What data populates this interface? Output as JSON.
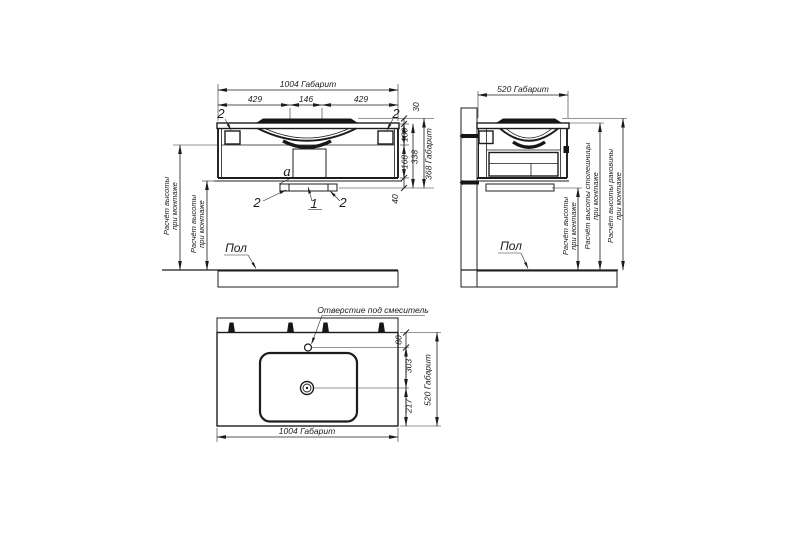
{
  "front_view": {
    "dim_width_total": "1004 Габарит",
    "dim_w_left": "429",
    "dim_w_center": "146",
    "dim_w_right": "429",
    "dim_h_rim": "30",
    "dim_h_basin": "130",
    "dim_h_body": "168",
    "dim_h_plinth": "40",
    "dim_h_under_top": "338",
    "dim_h_total": "368 Габарит",
    "callout_bracket": "2",
    "callout_center_bracket": "1",
    "callout_siphon": "a",
    "floor_label": "Пол",
    "mount_height_line1": "Расчёт высоты",
    "mount_height_line2": "при монтаже"
  },
  "side_view": {
    "dim_depth_total": "520 Габарит",
    "floor_label": "Пол",
    "mount_height_line1": "Расчёт высоты",
    "mount_height_line2": "при монтаже",
    "countertop_height_line1": "Расчёт высоты столешницы",
    "countertop_height_line2": "при монтаже",
    "sink_height_line1": "Расчёт высоты раковины",
    "sink_height_line2": "при монтаже"
  },
  "plan_view": {
    "mixer_callout": "Отверстие под смеситель",
    "dim_mixer_offset": "80",
    "dim_drain_offset": "303",
    "dim_drain_to_front": "217",
    "dim_depth_total": "520 Габарит",
    "dim_width_total": "1004 Габарит"
  }
}
